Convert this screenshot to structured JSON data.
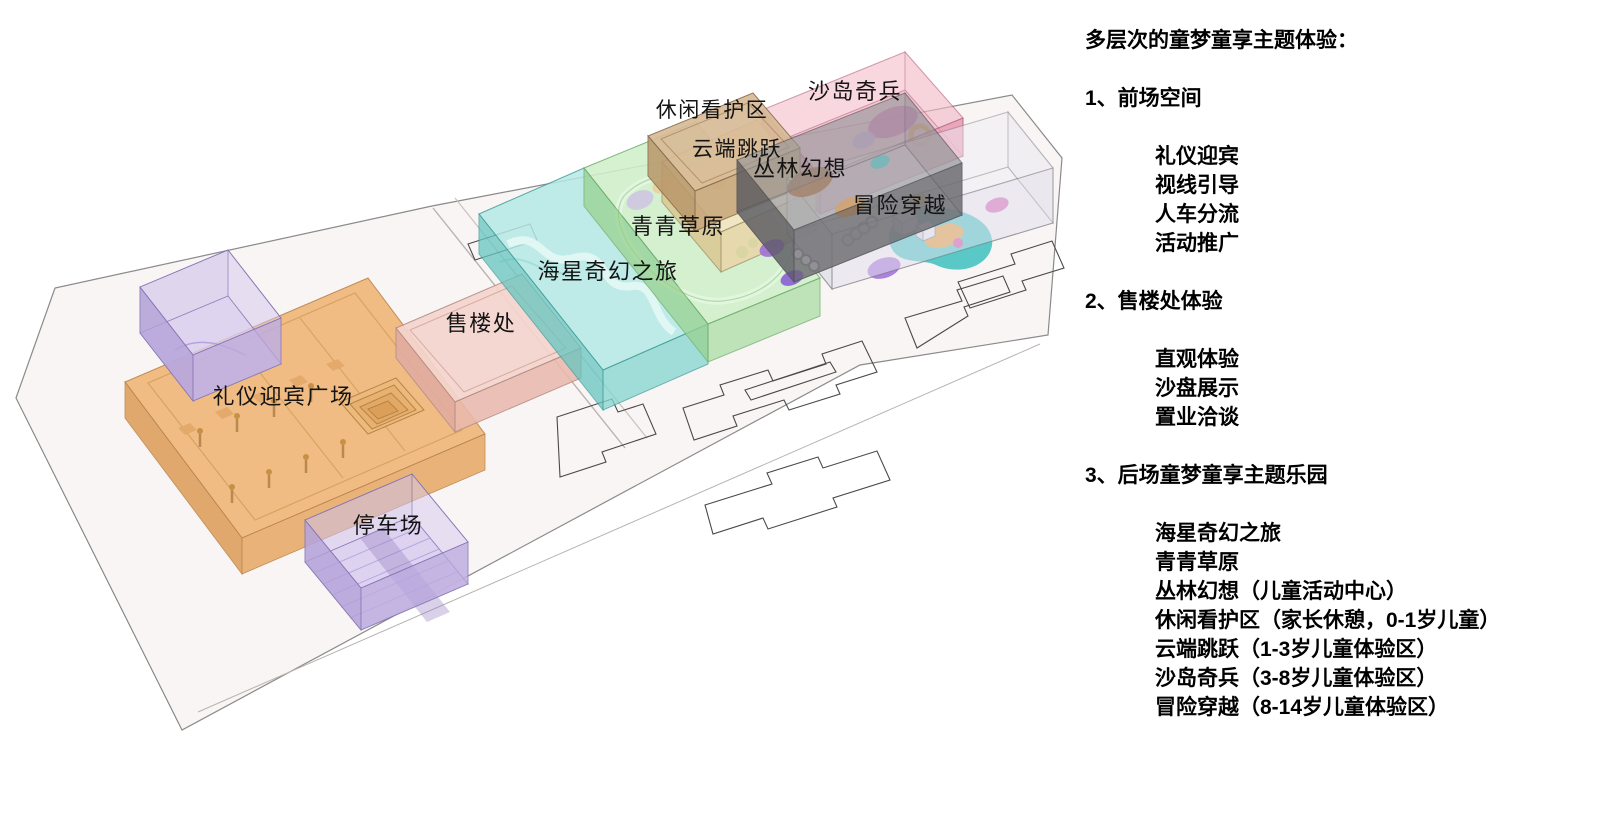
{
  "legend": {
    "title": "多层次的童梦童享主题体验：",
    "sections": [
      {
        "heading": "1、前场空间",
        "items": [
          "礼仪迎宾",
          "视线引导",
          "人车分流",
          "活动推广"
        ]
      },
      {
        "heading": "2、售楼处体验",
        "items": [
          "直观体验",
          "沙盘展示",
          "置业洽谈"
        ]
      },
      {
        "heading": "3、后场童梦童享主题乐园",
        "items": [
          "海星奇幻之旅",
          "青青草原",
          "丛林幻想（儿童活动中心）",
          "休闲看护区（家长休憩，0-1岁儿童）",
          "云端跳跃（1-3岁儿童体验区）",
          "沙岛奇兵（3-8岁儿童体验区）",
          "冒险穿越（8-14岁儿童体验区）"
        ]
      }
    ]
  },
  "diagram": {
    "zones": [
      {
        "id": "welcome-plaza",
        "label": "礼仪迎宾广场",
        "color": "#f0b87b"
      },
      {
        "id": "parking",
        "label": "停车场",
        "color": "#d9cdf0"
      },
      {
        "id": "sales-office",
        "label": "售楼处",
        "color": "#f4d5cd"
      },
      {
        "id": "starfish-journey",
        "label": "海星奇幻之旅",
        "color": "#a9e6e2"
      },
      {
        "id": "green-meadow",
        "label": "青青草原",
        "color": "#cbeec4"
      },
      {
        "id": "care-zone",
        "label": "休闲看护区",
        "color": "#d8bb97"
      },
      {
        "id": "cloud-jump",
        "label": "云端跳跃",
        "color": "#f4e6c2"
      },
      {
        "id": "sand-island",
        "label": "沙岛奇兵",
        "color": "#f2aabc"
      },
      {
        "id": "jungle-fantasy",
        "label": "丛林幻想",
        "color": "#9a9a9e"
      },
      {
        "id": "adventure-cross",
        "label": "冒险穿越",
        "color": "#f1eff5"
      },
      {
        "id": "entry-box",
        "label": "",
        "color": "#d9cdf0"
      }
    ],
    "ground_color": "#f9f5f4",
    "footprint_stroke": "#4a4a4a"
  }
}
